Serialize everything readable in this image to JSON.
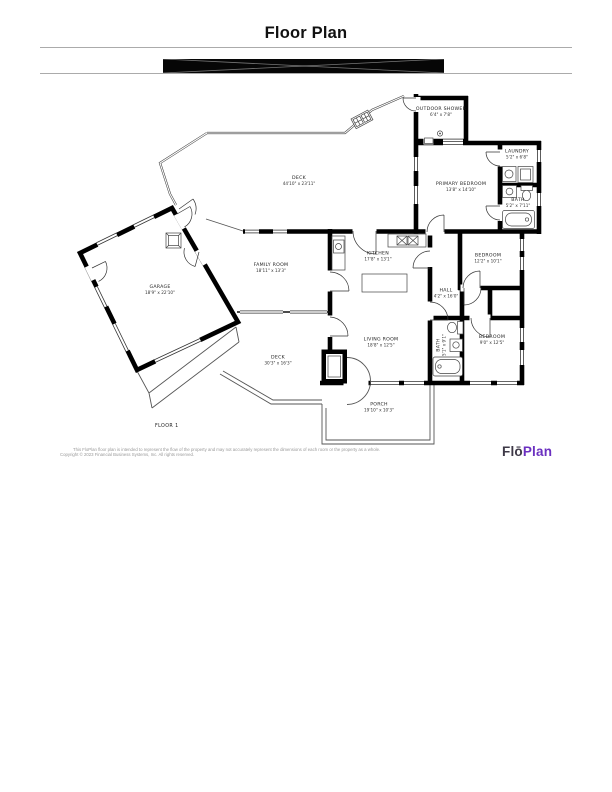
{
  "header": {
    "title": "Floor Plan"
  },
  "plan": {
    "floor_label": "FLOOR 1",
    "rooms": [
      {
        "name": "DECK",
        "dims": "44'10\" x 23'11\""
      },
      {
        "name": "OUTDOOR SHOWER",
        "dims": "6'4\" x 7'8\""
      },
      {
        "name": "PRIMARY BEDROOM",
        "dims": "13'8\" x 14'10\""
      },
      {
        "name": "LAUNDRY",
        "dims": "5'2\" x 6'8\""
      },
      {
        "name": "BATH",
        "dims": "5'2\" x 7'11\""
      },
      {
        "name": "GARAGE",
        "dims": "18'9\" x 22'10\""
      },
      {
        "name": "FAMILY ROOM",
        "dims": "18'11\" x 13'3\""
      },
      {
        "name": "KITCHEN",
        "dims": "17'8\" x 13'1\""
      },
      {
        "name": "BEDROOM",
        "dims": "12'2\" x 10'1\""
      },
      {
        "name": "HALL",
        "dims": "4'2\" x 16'0\""
      },
      {
        "name": "LIVING ROOM",
        "dims": "18'8\" x 12'5\""
      },
      {
        "name": "BATH",
        "dims": "5'1\" x 9'1\""
      },
      {
        "name": "BEDROOM",
        "dims": "9'0\" x 12'5\""
      },
      {
        "name": "DECK",
        "dims": "30'3\" x 16'3\""
      },
      {
        "name": "PORCH",
        "dims": "19'10\" x 10'3\""
      }
    ]
  },
  "footer": {
    "disclaimer_line1": "This FloPlan floor plan is intended to represent the flow of the property and may not accurately represent the dimensions of each room or the property as a whole.",
    "disclaimer_line2": "Copyright © 2023 Financial Business Systems, Inc. All rights reserved.",
    "logo_part1": "Flō",
    "logo_part2": "Plan"
  },
  "colors": {
    "wall": "#000000",
    "thin_line": "#555555",
    "rule": "#ababab",
    "redaction_bar": "#060606",
    "logo_dark": "#3e3947",
    "logo_purple": "#6b30c0"
  }
}
